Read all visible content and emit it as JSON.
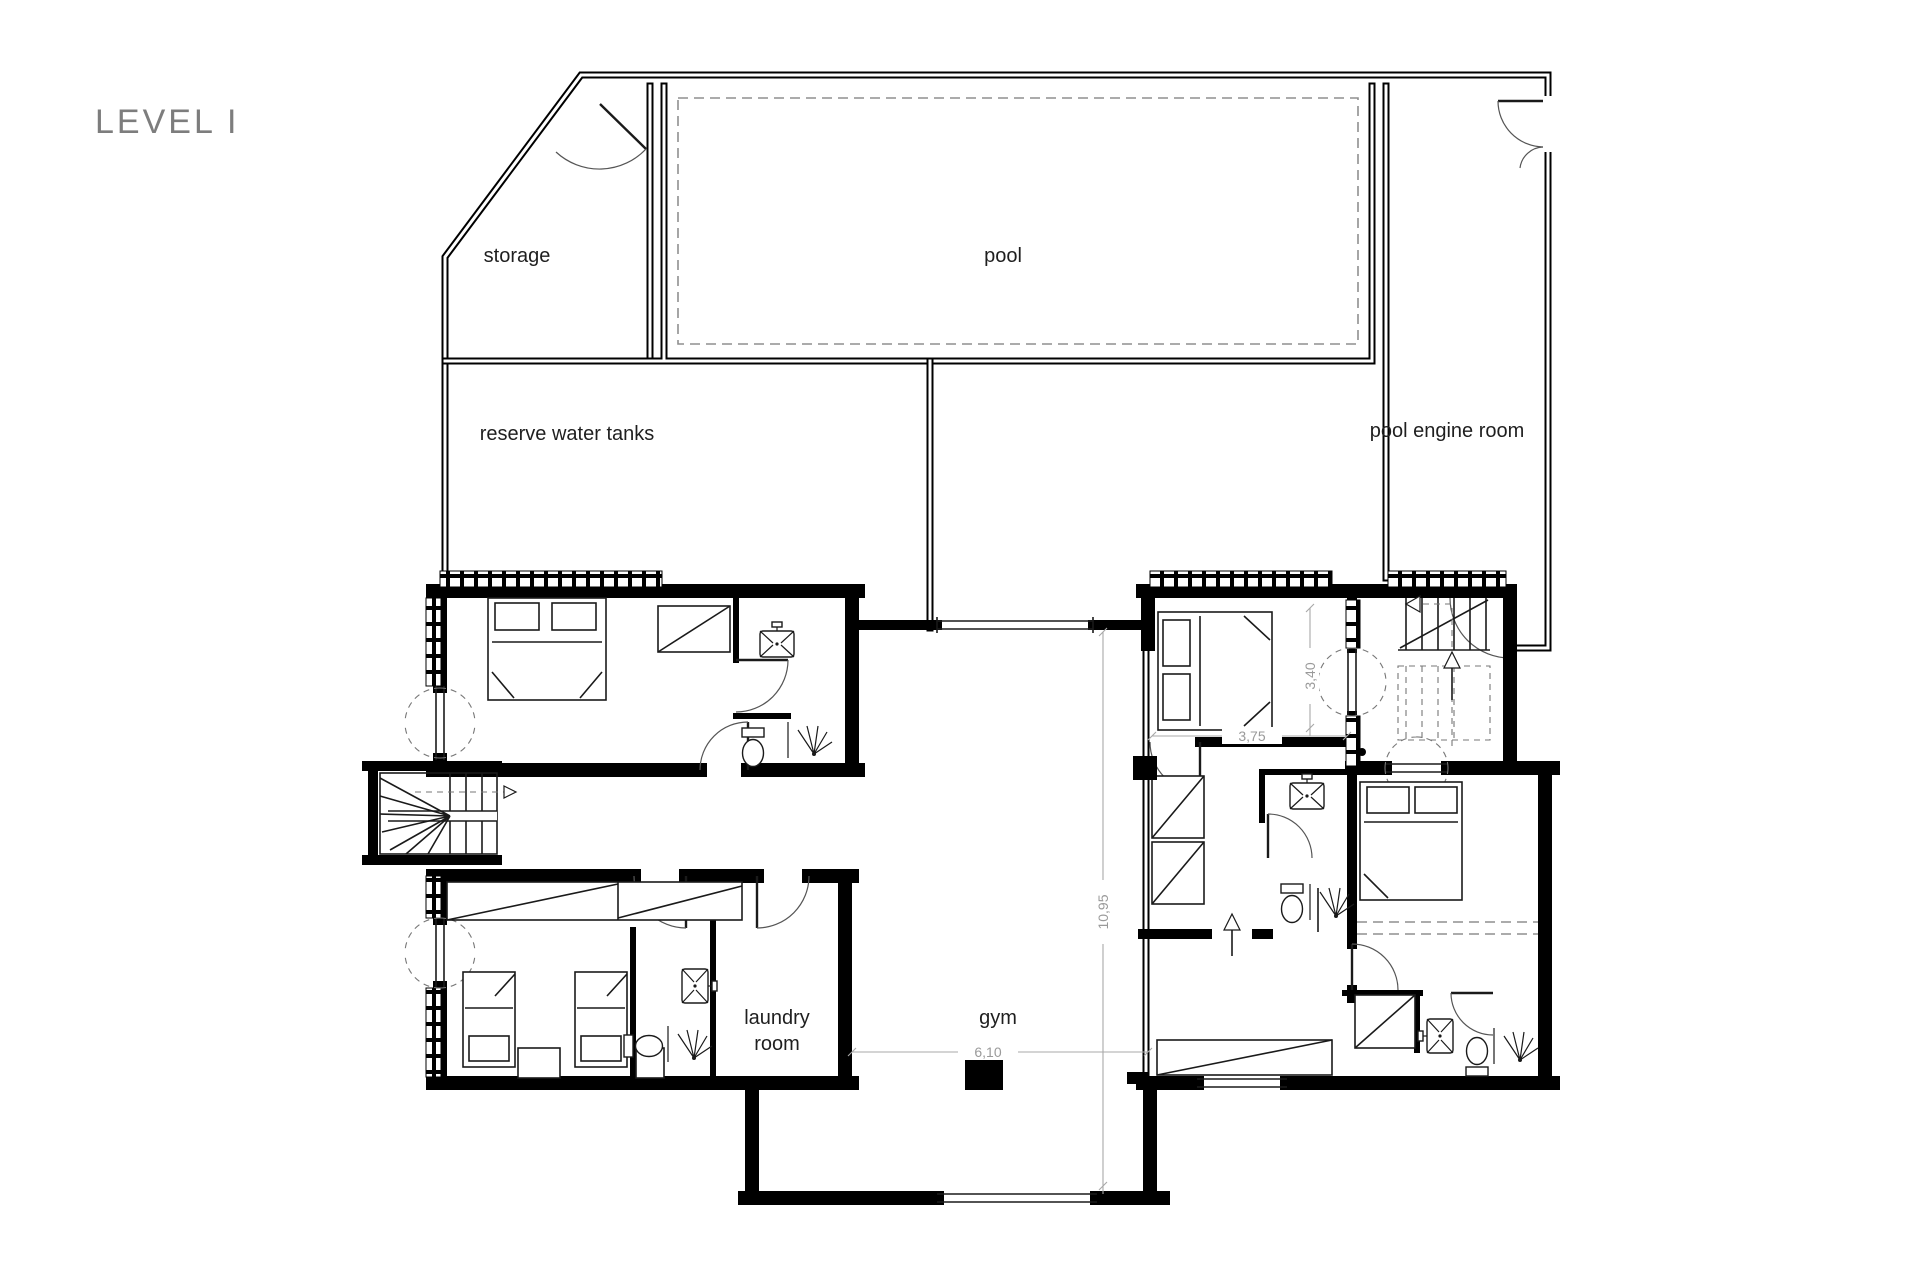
{
  "title": "LEVEL I",
  "rooms": {
    "storage": "storage",
    "pool": "pool",
    "reserve_water_tanks": "reserve water tanks",
    "pool_engine_room": "pool engine room",
    "laundry_line1": "laundry",
    "laundry_line2": "room",
    "gym": "gym"
  },
  "dimensions": {
    "bedroom_width": "3,75",
    "bedroom_height": "3,40",
    "gym_height": "10,95",
    "gym_width": "6,10"
  },
  "colors": {
    "wall": "#000000",
    "thin_line": "#1a1a1a",
    "dashed": "#8f8f8f",
    "dimension": "#9a9a9a",
    "room_label": "#1f1f1f",
    "title": "#7d7d7d",
    "background": "#ffffff"
  }
}
